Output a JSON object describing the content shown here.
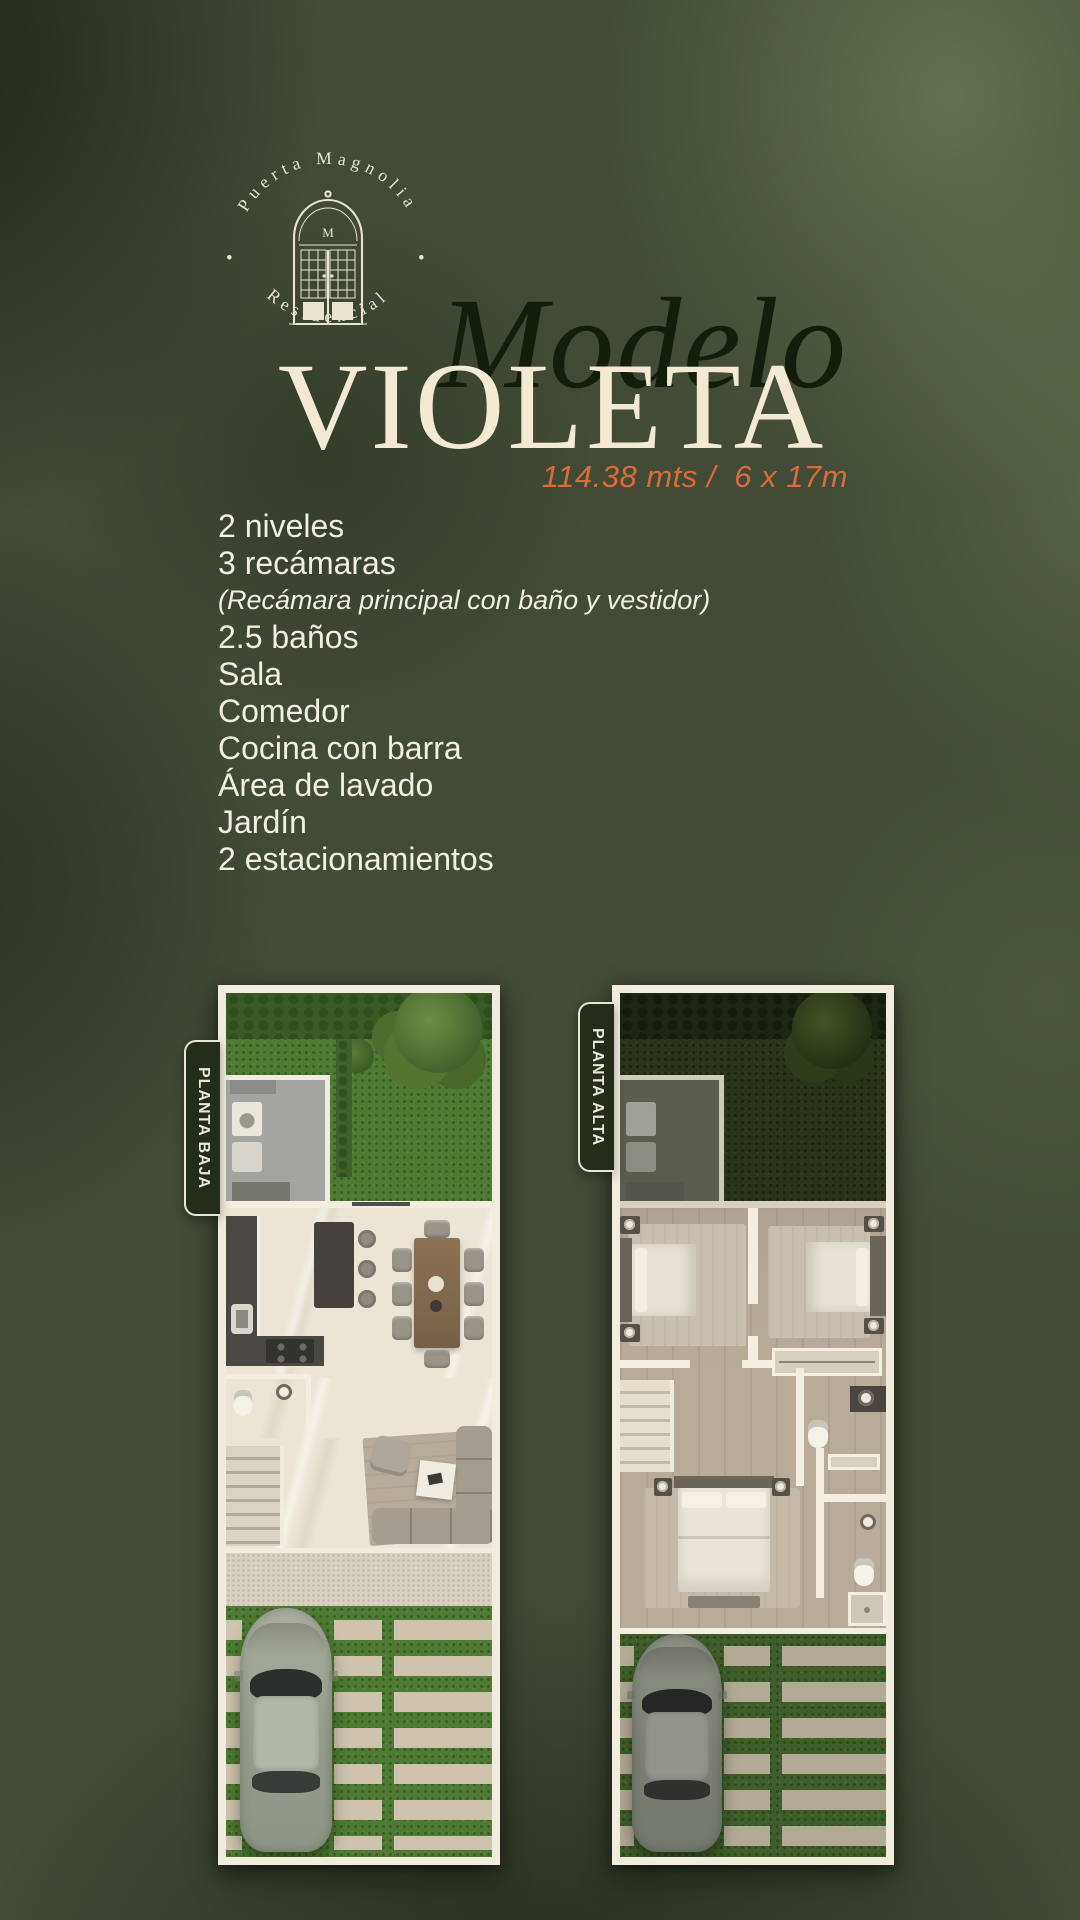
{
  "brand": {
    "arc_top": "Puerta Magnolia",
    "arc_bottom": "Residencial",
    "bullet": "•",
    "monogram": "M"
  },
  "title": {
    "pretitle": "Modelo",
    "name": "VIOLETA",
    "dimensions": "114.38 mts /  6 x 17m"
  },
  "features": [
    {
      "text": "2 niveles",
      "style": "normal"
    },
    {
      "text": "3 recámaras",
      "style": "normal"
    },
    {
      "text": "(Recámara principal con baño y vestidor)",
      "style": "italic"
    },
    {
      "text": "2.5 baños",
      "style": "normal"
    },
    {
      "text": "Sala",
      "style": "normal"
    },
    {
      "text": "Comedor",
      "style": "normal"
    },
    {
      "text": "Cocina con barra",
      "style": "normal"
    },
    {
      "text": "Área de lavado",
      "style": "normal"
    },
    {
      "text": "Jardín",
      "style": "normal"
    },
    {
      "text": "2 estacionamientos",
      "style": "normal"
    }
  ],
  "floorplans": [
    {
      "label": "PLANTA BAJA"
    },
    {
      "label": "PLANTA ALTA"
    }
  ],
  "colors": {
    "background_olive": "#414b36",
    "accent_orange": "#db6b3b",
    "cream": "#f3e9d5",
    "title_dark_green": "#131d0b"
  }
}
